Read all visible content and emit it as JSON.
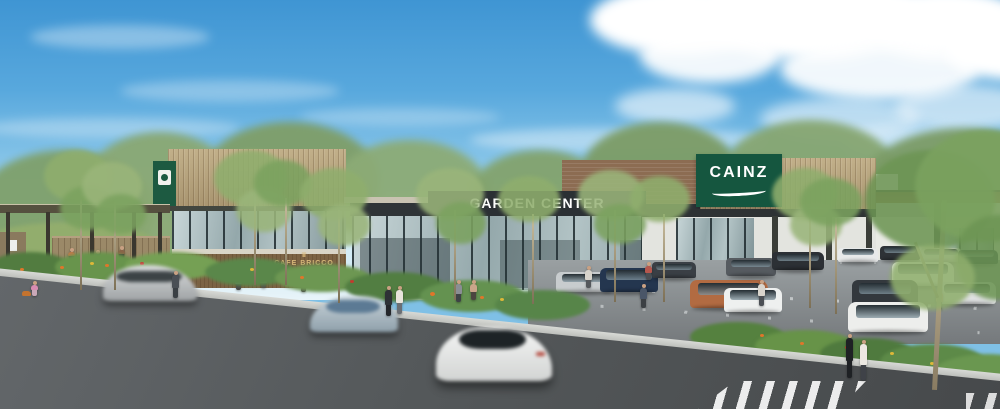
{
  "meta": {
    "type": "architectural-rendering",
    "subject": "Exterior rendering of a CAINZ home-center shopping complex with garden center, Cafe Bricco, tree-lined parking lot, street traffic, pedestrians and a crosswalk",
    "sky": "blue sky, cumulus clouds upper right, wispy clouds left"
  },
  "signs": {
    "cainz": {
      "label": "CAINZ",
      "panel_color": "#15563f",
      "text_color": "#ffffff"
    },
    "garden_center": {
      "label": "GARDEN CENTER",
      "panel_color": "#2b3034",
      "text_color": "#ffffff"
    },
    "cafe_bricco": {
      "label": "CAFE BRICCO",
      "crown_icon": "♛",
      "text_color": "#d9b87a",
      "wall_color": "#7c6344"
    },
    "entrance_banner": {
      "panel_color": "#1d5a41"
    }
  },
  "vehicles": {
    "street": [
      "silver minivan motion-blurred",
      "silver-blue sedan motion-blurred",
      "white sedan motion-blurred"
    ],
    "parking_lot_colors": [
      "silver",
      "navy",
      "copper",
      "white",
      "dark-gray"
    ]
  },
  "environment": {
    "road_color": "#54585a",
    "parking_color": "#8d9294",
    "foliage_color": "#6d9554",
    "wood_facade_color": "#b5a17d",
    "brick_color": "#8c6c52",
    "sky_top": "#3f95d3",
    "sky_horizon": "#e8f4f9",
    "crosswalk": "white zebra stripes bottom right"
  }
}
